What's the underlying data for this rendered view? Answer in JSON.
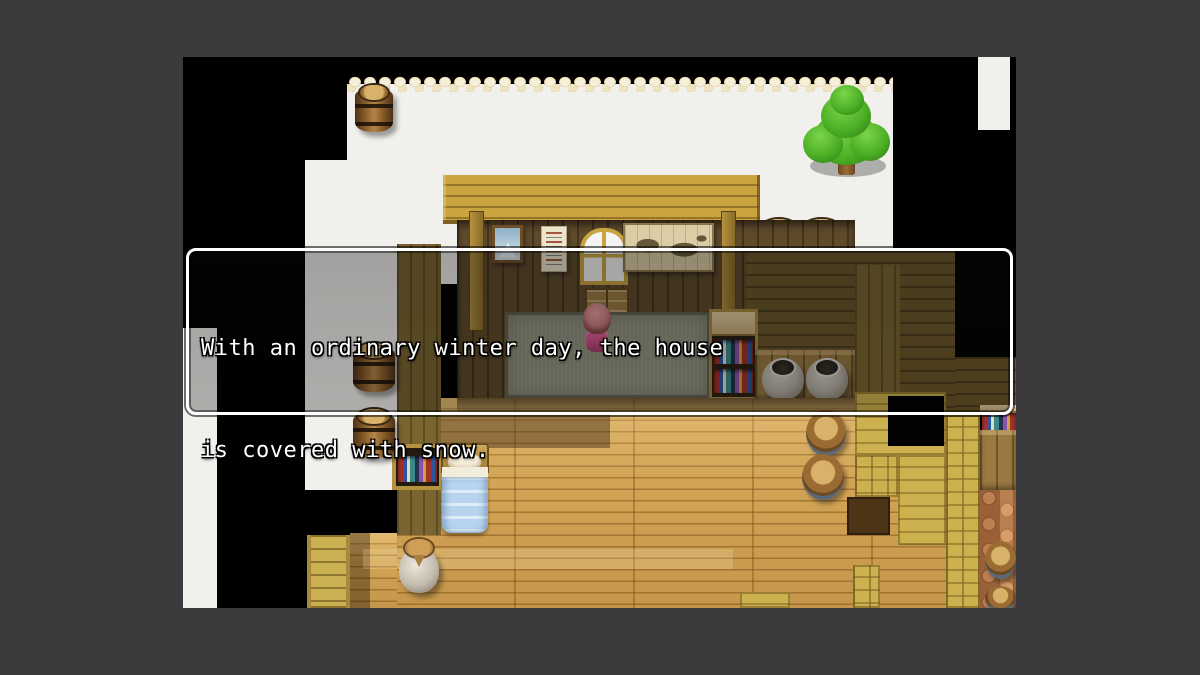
{
  "dialog": {
    "lines": [
      "With an ordinary winter day, the house",
      "is covered with snow."
    ]
  },
  "palette": {
    "frame_bg": "#3b3b3d",
    "snow": "#f1f0ed",
    "snow_edge": "#ddc996",
    "wood_gold": "#c9a43f",
    "wood_pale": "#cdb14e",
    "wall_dark": "#5f4a2a",
    "wall_olive": "#6a5628",
    "floor": "#d2a455",
    "mat": "#90907e",
    "cobble": "#9a6138",
    "blanket": "#b7d4ee",
    "tree_light": "#7cd44a",
    "tree_mid": "#49ae24",
    "tree_dark": "#2e7a14",
    "hair": "#e89f9f",
    "dress": "#cf5288",
    "dialog_border": "#ffffff"
  }
}
